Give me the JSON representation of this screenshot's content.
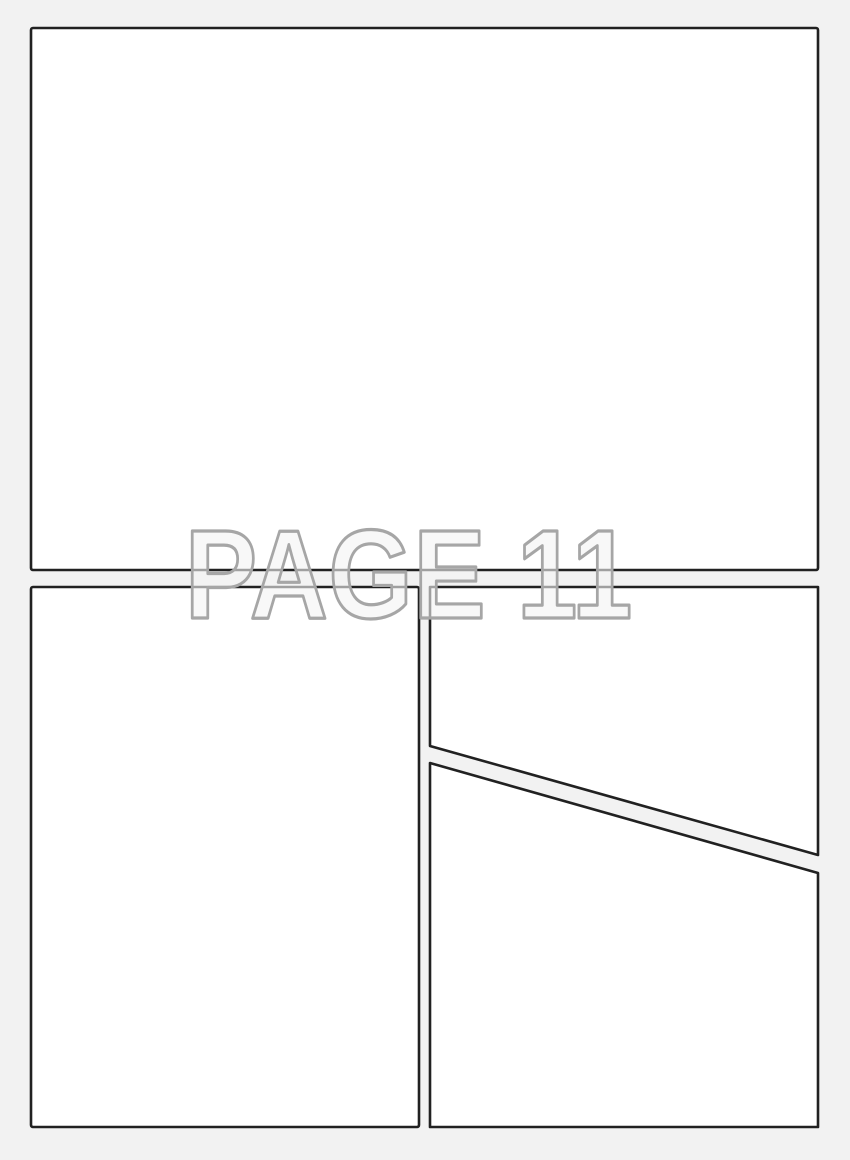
{
  "page": {
    "label": "PAGE 11",
    "background_color": "#f2f2f2",
    "panel_fill_color": "#ffffff",
    "panel_border_color": "#212121",
    "label_outline_color": "#a6a6a6",
    "label_fill_color": "#f3f3f3",
    "panel_count": 4,
    "panels": [
      {
        "name": "top-full-width"
      },
      {
        "name": "bottom-left-tall"
      },
      {
        "name": "bottom-right-upper-diagonal"
      },
      {
        "name": "bottom-right-lower-diagonal"
      }
    ]
  }
}
